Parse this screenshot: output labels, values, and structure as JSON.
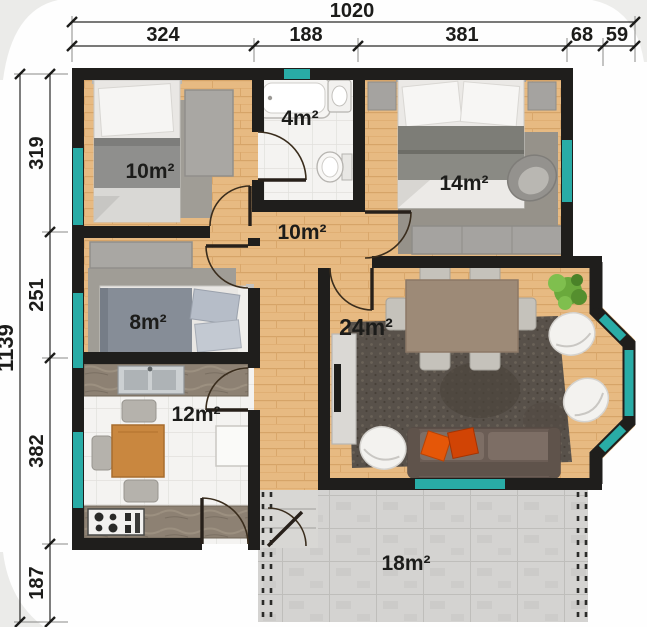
{
  "title": "apartment-floor-plan",
  "dimensions": {
    "top": {
      "total": "1020",
      "segments": [
        "324",
        "188",
        "381",
        "68",
        "59"
      ]
    },
    "left": {
      "total": "1139",
      "segments": [
        "319",
        "251",
        "382",
        "187"
      ]
    }
  },
  "rooms": [
    {
      "id": "bedroom-1",
      "label": "10m²"
    },
    {
      "id": "bathroom",
      "label": "4m²"
    },
    {
      "id": "bedroom-2",
      "label": "14m²"
    },
    {
      "id": "hallway",
      "label": "10m²"
    },
    {
      "id": "bedroom-3",
      "label": "8m²"
    },
    {
      "id": "living-room",
      "label": "24m²"
    },
    {
      "id": "kitchen",
      "label": "12m²"
    },
    {
      "id": "terrace",
      "label": "18m²"
    }
  ],
  "colors": {
    "wall": "#1f1e1c",
    "window": "#29aca6",
    "wood_floor": "#e7ba82",
    "tile_floor": "#f4f3f1",
    "terrace_paver": "#d4d3d1",
    "accent_pillow": "#e55708"
  }
}
